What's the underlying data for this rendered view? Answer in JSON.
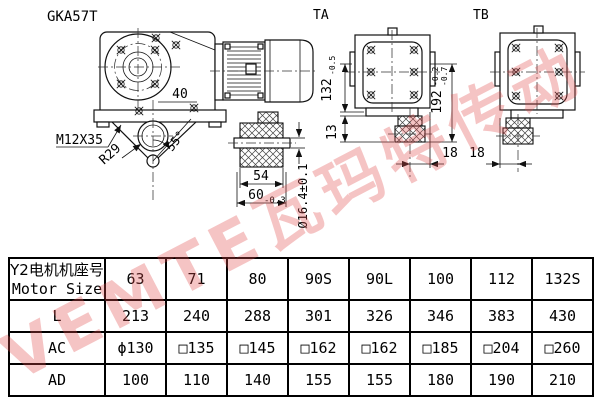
{
  "drawing": {
    "model": "GKA57T",
    "view_ta": "TA",
    "view_tb": "TB",
    "dim_40": "40",
    "dim_bolt": "M12X35",
    "dim_r29": "R29",
    "dim_angle": "55°",
    "dim_54": "54",
    "dim_60": "60",
    "dim_60_tol": "-0.3",
    "dim_bore": "Ø16.4±0.1",
    "dim_13": "13",
    "dim_132": "132",
    "dim_132_tol": "-0.5",
    "dim_192": "192",
    "dim_192_tol_up": "-0.2",
    "dim_192_tol_dn": "-0.7",
    "dim_18_left": "18",
    "dim_18_right": "18"
  },
  "watermark": {
    "text": "VEMTE瓦玛特传动"
  },
  "table": {
    "header": {
      "line1": "Y2电机机座号",
      "line2": "Motor Size"
    },
    "columns": [
      "63",
      "71",
      "80",
      "90S",
      "90L",
      "100",
      "112",
      "132S"
    ],
    "rows": [
      {
        "label": "L",
        "values": [
          "213",
          "240",
          "288",
          "301",
          "326",
          "346",
          "383",
          "430"
        ]
      },
      {
        "label": "AC",
        "values": [
          "ϕ130",
          "□135",
          "□145",
          "□162",
          "□162",
          "□185",
          "□204",
          "□260"
        ]
      },
      {
        "label": "AD",
        "values": [
          "100",
          "110",
          "140",
          "155",
          "155",
          "180",
          "190",
          "210"
        ]
      }
    ]
  }
}
